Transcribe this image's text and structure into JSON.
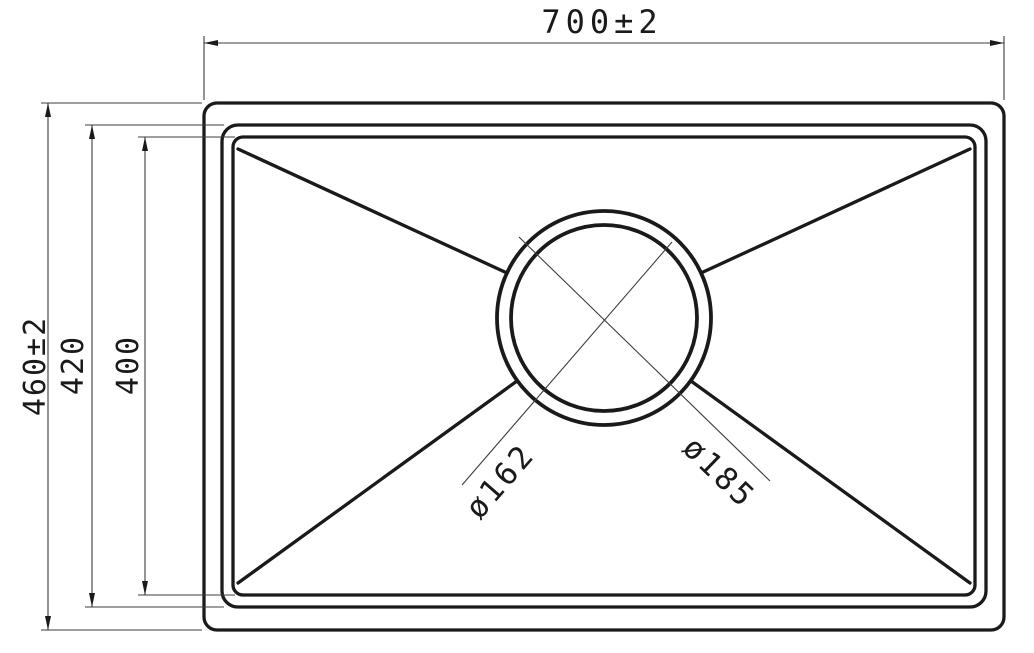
{
  "drawing": {
    "background_color": "#ffffff",
    "line_color": "#1a1a1a",
    "thin_line_color": "#3d3d3d",
    "dimensions": {
      "top_width": "700±2",
      "overall_height": "460±2",
      "bowl_outer_height": "420",
      "bowl_inner_height": "400",
      "drain_inner_diameter": "ø162",
      "drain_outer_diameter": "ø185"
    }
  }
}
